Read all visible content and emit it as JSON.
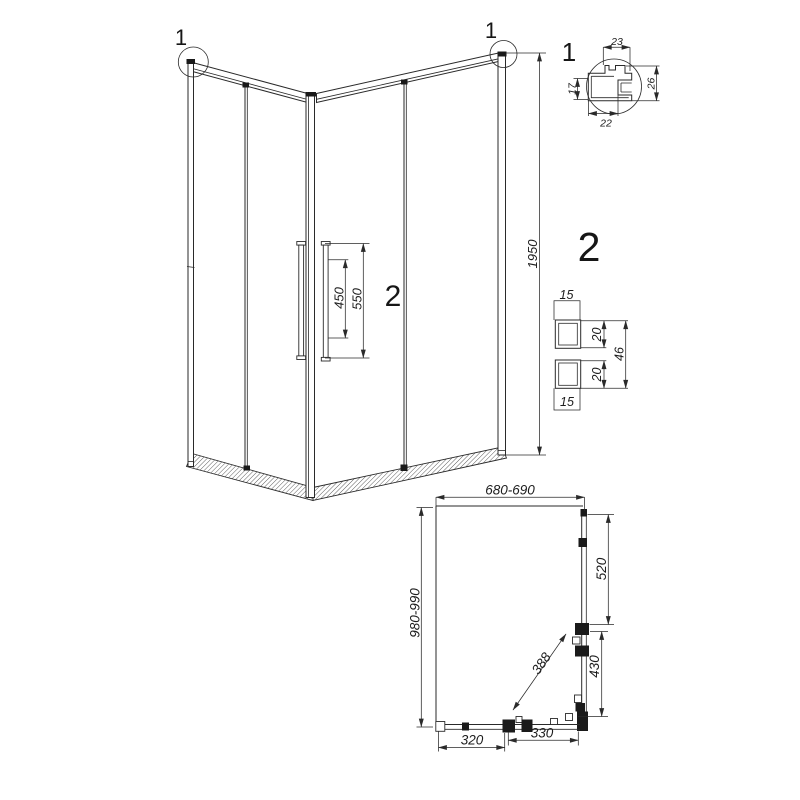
{
  "page": {
    "background": "#ffffff",
    "line_color": "#2a2a2a"
  },
  "elevation": {
    "callout_left": "1",
    "callout_right": "1",
    "panel_label": "2",
    "dim_height": "1950",
    "dim_handle_spacing": "450",
    "dim_handle_length": "550"
  },
  "profile_detail": {
    "label": "1",
    "dim_top": "23",
    "dim_left": "17",
    "dim_right": "26",
    "dim_bottom": "22"
  },
  "panel_detail": {
    "label": "2",
    "dim_top_width": "15",
    "dim_upper_height": "20",
    "dim_total_height": "46",
    "dim_lower_height": "20",
    "dim_bottom_width": "15"
  },
  "plan": {
    "dim_width": "680-690",
    "dim_depth": "980-990",
    "dim_side_fixed": "520",
    "dim_side_door": "430",
    "dim_entry_diagonal": "388",
    "dim_front_fixed": "320",
    "dim_front_door": "330"
  }
}
